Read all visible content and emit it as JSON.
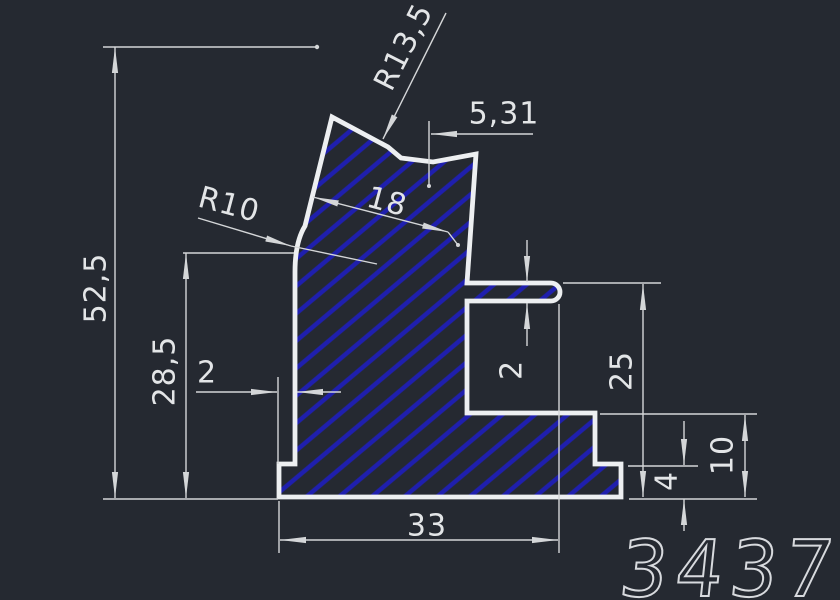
{
  "window": {
    "background": "#252931"
  },
  "drawing": {
    "type": "cad-profile-cross-section",
    "part_number": "3437",
    "labels": {
      "total_height": "52,5",
      "upper_height": "28,5",
      "left_lip_width": "2",
      "top_width": "18",
      "notch_radius": "R13,5",
      "left_radius": "R10",
      "notch_offset": "5,31",
      "fin_thickness": "2",
      "right_height": "25",
      "step_height": "10",
      "base_thickness": "4",
      "base_width": "33"
    },
    "colors": {
      "background": "#252931",
      "outline": "#edeff1",
      "dimension_lines": "#d4d6d8",
      "text": "#e3e5e7",
      "hatch_blue": "#1f1fae",
      "part_number_stroke": "#d8dade"
    }
  }
}
